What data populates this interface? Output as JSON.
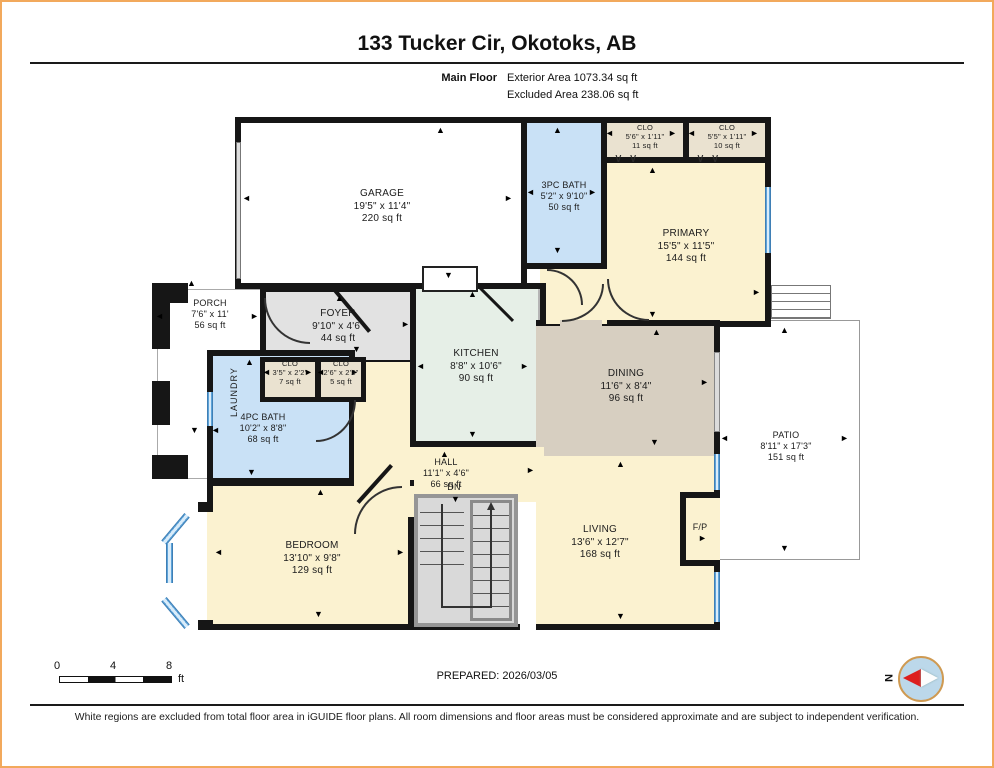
{
  "page": {
    "title": "133 Tucker Cir, Okotoks, AB",
    "floor_label": "Main Floor",
    "exterior_area": "Exterior Area 1073.34 sq ft",
    "excluded_area": "Excluded Area 238.06 sq ft",
    "prepared": "PREPARED: 2026/03/05",
    "compass_label": "N",
    "disclaimer": "White regions are excluded from total floor area in iGUIDE floor plans. All room dimensions and floor areas must be considered approximate and are subject to independent verification."
  },
  "scale_bar": {
    "ticks": [
      "0",
      "4",
      "8"
    ],
    "unit": "ft"
  },
  "rooms": {
    "garage": {
      "name": "GARAGE",
      "dims": "19'5\" x 11'4\"",
      "area": "220 sq ft"
    },
    "bath3pc": {
      "name": "3PC BATH",
      "dims": "5'2\" x 9'10\"",
      "area": "50 sq ft"
    },
    "clo_primary_left": {
      "name": "CLO",
      "dims": "5'6\" x 1'11\"",
      "area": "11 sq ft"
    },
    "clo_primary_right": {
      "name": "CLO",
      "dims": "5'5\" x 1'11\"",
      "area": "10 sq ft"
    },
    "primary": {
      "name": "PRIMARY",
      "dims": "15'5\" x 11'5\"",
      "area": "144 sq ft"
    },
    "porch": {
      "name": "PORCH",
      "dims": "7'6\" x 11'",
      "area": "56 sq ft"
    },
    "foyer": {
      "name": "FOYER",
      "dims": "9'10\" x 4'6\"",
      "area": "44 sq ft"
    },
    "laundry": {
      "name": "LAUNDRY"
    },
    "clo_foyer_left": {
      "name": "CLO",
      "dims": "3'5\" x 2'2\"",
      "area": "7 sq ft"
    },
    "clo_foyer_right": {
      "name": "CLO",
      "dims": "2'6\" x 2'2\"",
      "area": "5 sq ft"
    },
    "bath4pc": {
      "name": "4PC BATH",
      "dims": "10'2\" x 8'8\"",
      "area": "68 sq ft"
    },
    "kitchen": {
      "name": "KITCHEN",
      "dims": "8'8\" x 10'6\"",
      "area": "90 sq ft"
    },
    "dining": {
      "name": "DINING",
      "dims": "11'6\" x 8'4\"",
      "area": "96 sq ft"
    },
    "hall": {
      "name": "HALL",
      "dims": "11'1\" x 4'6\"",
      "area": "66 sq ft"
    },
    "living": {
      "name": "LIVING",
      "dims": "13'6\" x 12'7\"",
      "area": "168 sq ft"
    },
    "bedroom": {
      "name": "BEDROOM",
      "dims": "13'10\" x 9'8\"",
      "area": "129 sq ft"
    },
    "patio": {
      "name": "PATIO",
      "dims": "8'11\" x 17'3\"",
      "area": "151 sq ft"
    },
    "fireplace": {
      "name": "F/P"
    },
    "stairs": {
      "label": "DN"
    }
  },
  "colors": {
    "wall": "#161616",
    "room_cream": "#fbf2d0",
    "room_blue": "#c9e1f6",
    "room_gray": "#e2e2e2",
    "room_mint": "#e6efe7",
    "room_taupe": "#d7cfc1",
    "room_tan": "#eae2d0",
    "window": "#5ea3d8",
    "page_border": "#f2a95c"
  }
}
